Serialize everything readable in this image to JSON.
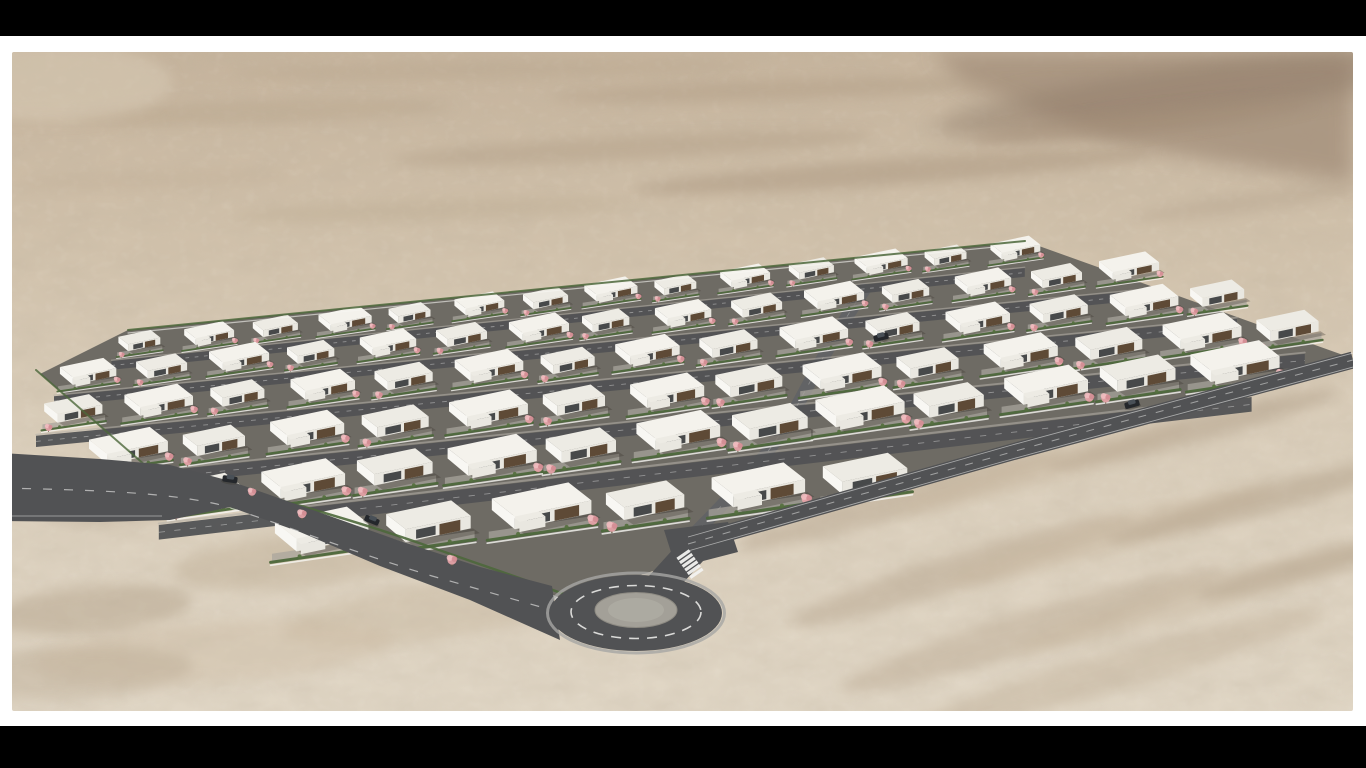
{
  "scene": {
    "description": "Aerial 3D architectural rendering of a modern desert housing development: staggered rows of white flat-roofed villas with dark wood facades, pink blossom trees and green hedges, gray internal streets, a perimeter access road and a roundabout with a zebra crossing, surrounded by sandy desert hills",
    "letterbox": {
      "top_height": 36,
      "bottom_height": 42,
      "color": "#000000"
    },
    "page_background": "#ffffff",
    "photo": {
      "x": 12,
      "y": 52,
      "width": 1341,
      "height": 659
    },
    "palette": {
      "sandTop": "#c6b49d",
      "sandMid": "#d2c3ad",
      "sandLow": "#dbcfbc",
      "sandBottom": "#e0d6c5",
      "ridge": "#a4907c",
      "ridgeDark": "#8f7b69",
      "asphalt": "#515254",
      "asphaltLight": "#626365",
      "roadLine": "#f2f2f0",
      "platform": "#6e6b64",
      "paving": "#a9a59c",
      "roof": "#f4f2ec",
      "roofAlt": "#edebe4",
      "facade": "#e9e7e0",
      "wallLight": "#f8f7f3",
      "wood": "#5e4a36",
      "glass": "#35373a",
      "hedge": "#4d683b",
      "shrub": "#55703f",
      "blossom": "#e4a2a8",
      "blossomLight": "#f0bcc0",
      "blossomDark": "#d38d94",
      "trunk": "#6e5b45",
      "island": "#a3a098",
      "islandInner": "#aeaba2",
      "apron": "#a6a6a4",
      "carDark": "#24272b",
      "carCabin": "#495057",
      "shadow": "#3a362f"
    },
    "desert": {
      "ridge_polygon": "920,0 1341,0 1341,132 1110,94 952,32",
      "ridge_ellipse": [
        1180,
        40,
        260,
        26,
        "#8f7b69",
        0.5,
        -8
      ],
      "streaks": [
        [
          250,
          60,
          190,
          11,
          "#b9a78f",
          0.5,
          -2
        ],
        [
          620,
          96,
          240,
          12,
          "#b19e86",
          0.45,
          -3
        ],
        [
          420,
          158,
          200,
          11,
          "#bcab92",
          0.4,
          -2
        ],
        [
          880,
          120,
          260,
          13,
          "#ab9780",
          0.5,
          -4
        ],
        [
          1130,
          70,
          170,
          12,
          "#a48f79",
          0.5,
          -6
        ],
        [
          140,
          128,
          140,
          10,
          "#c2b099",
          0.4,
          -2
        ],
        [
          760,
          38,
          220,
          10,
          "#b09c84",
          0.45,
          -2
        ],
        [
          1240,
          150,
          120,
          10,
          "#b4a28c",
          0.4,
          -8
        ],
        [
          480,
          18,
          260,
          9,
          "#b7a58d",
          0.4,
          -1
        ],
        [
          60,
          70,
          90,
          9,
          "#c6b49c",
          0.4,
          0
        ],
        [
          110,
          448,
          90,
          22,
          "#b5a48d",
          0.45,
          -4
        ],
        [
          290,
          508,
          130,
          26,
          "#bcab92",
          0.4,
          -6
        ],
        [
          80,
          558,
          100,
          24,
          "#ab9980",
          0.38,
          -5
        ],
        [
          420,
          560,
          150,
          28,
          "#c4b39a",
          0.35,
          -8
        ],
        [
          200,
          600,
          180,
          30,
          "#cdbca4",
          0.4,
          -4
        ],
        [
          60,
          620,
          120,
          26,
          "#b5a48d",
          0.35,
          -3
        ],
        [
          890,
          448,
          170,
          16,
          "#b2a089",
          0.42,
          -16
        ],
        [
          1030,
          416,
          150,
          14,
          "#cbbaa2",
          0.4,
          -16
        ],
        [
          1180,
          378,
          150,
          13,
          "#ac9a83",
          0.42,
          -15
        ],
        [
          950,
          518,
          180,
          18,
          "#b2a089",
          0.42,
          -17
        ],
        [
          1100,
          483,
          170,
          16,
          "#cbbaa2",
          0.4,
          -16
        ],
        [
          1250,
          448,
          160,
          14,
          "#ab9981",
          0.42,
          -15
        ],
        [
          1020,
          578,
          200,
          20,
          "#b7a58e",
          0.4,
          -17
        ],
        [
          1180,
          548,
          180,
          16,
          "#c6b59d",
          0.38,
          -16
        ],
        [
          1320,
          508,
          140,
          13,
          "#ae9c85",
          0.4,
          -15
        ],
        [
          1100,
          620,
          220,
          20,
          "#bfae96",
          0.38,
          -16
        ],
        [
          40,
          30,
          120,
          40,
          "#d8cbb6",
          0.5,
          0
        ]
      ]
    },
    "development": {
      "platform_points": "28,322 116,278 1013,189 1331,303 1188,341 1088,368 988,396 888,425 788,460 688,487 662,512 554,548 408,498 243,446 138,418",
      "back_hedge": {
        "x1": 116,
        "y1": 278,
        "x2": 1013,
        "y2": 189
      },
      "left_edge_hedge": {
        "x1": 24,
        "y1": 318,
        "x2": 134,
        "y2": 414
      },
      "front_wall_d": "M138,418 C243,446 330,470 408,498 C470,520 524,538 560,552",
      "front_hedge_d": "M134,412 C240,440 330,464 410,492 C472,514 526,532 562,546"
    },
    "rows": [
      {
        "x1": 118,
        "y1": 293,
        "x2": 988,
        "y2": 200,
        "count": 14,
        "scale": 0.62,
        "street": true
      },
      {
        "x1": 63,
        "y1": 326,
        "x2": 1103,
        "y2": 220,
        "count": 15,
        "scale": 0.7,
        "street": true
      },
      {
        "x1": 48,
        "y1": 363,
        "x2": 1193,
        "y2": 246,
        "count": 15,
        "scale": 0.8,
        "street": true
      },
      {
        "x1": 98,
        "y1": 403,
        "x2": 1256,
        "y2": 278,
        "count": 14,
        "scale": 0.92,
        "street": true
      },
      {
        "x1": 178,
        "y1": 446,
        "x2": 1198,
        "y2": 318,
        "count": 12,
        "scale": 1.04,
        "street": true
      },
      {
        "x1": 288,
        "y1": 488,
        "x2": 828,
        "y2": 431,
        "count": 6,
        "scale": 1.16,
        "street": false
      }
    ],
    "roads": {
      "left_polygon": "-11,401 88,407 158,413 218,429 298,457 388,489 468,515 540,534 548,588 458,548 368,514 288,480 218,455 158,468 88,470 -11,469",
      "left_centerline_d": "M-11,436 C80,438 150,440 205,452 C260,468 340,500 420,524 C470,538 510,550 540,558",
      "left_edge_line_d": "M-11,464 L150,464",
      "right_d": "M676,492 C800,456 900,428 1000,400 C1100,372 1220,340 1341,308",
      "right_edge_top_d": "M676,485 C800,449 900,421 1000,393 C1100,365 1220,333 1341,301",
      "right_edge_bottom_d": "M676,499 C800,463 900,435 1000,407 C1100,379 1220,347 1341,315",
      "right_width": 17,
      "junction_flare": "652,478 716,470 726,500 664,516",
      "stub": {
        "x1": 688,
        "y1": 490,
        "x2": 648,
        "y2": 534,
        "width": 30
      },
      "interior_d": "M678,486 C724,440 758,404 786,352 C806,315 824,280 852,238",
      "interior_width": 13
    },
    "roundabout": {
      "cx": 624,
      "cy": 561,
      "rx": 86,
      "ry": 38,
      "ring_rx": 65,
      "ring_ry": 26.5,
      "island_rx": 41,
      "island_ry": 17.5,
      "inner_rx": 28,
      "inner_ry": 12
    },
    "crosswalk": {
      "cx": 678,
      "cy": 512,
      "angle": -35,
      "stripes": 6,
      "len": 15,
      "w": 3.2,
      "step_x": 2.6,
      "step_y": 3.7
    },
    "cars": [
      {
        "x": 218,
        "y": 427,
        "a": 8
      },
      {
        "x": 360,
        "y": 468,
        "a": 22
      },
      {
        "x": 869,
        "y": 285,
        "a": -14
      },
      {
        "x": 1120,
        "y": 352,
        "a": -15
      }
    ],
    "extra_trees": [
      [
        290,
        462,
        1.0
      ],
      [
        440,
        508,
        1.1
      ],
      [
        240,
        440,
        0.9
      ]
    ]
  }
}
